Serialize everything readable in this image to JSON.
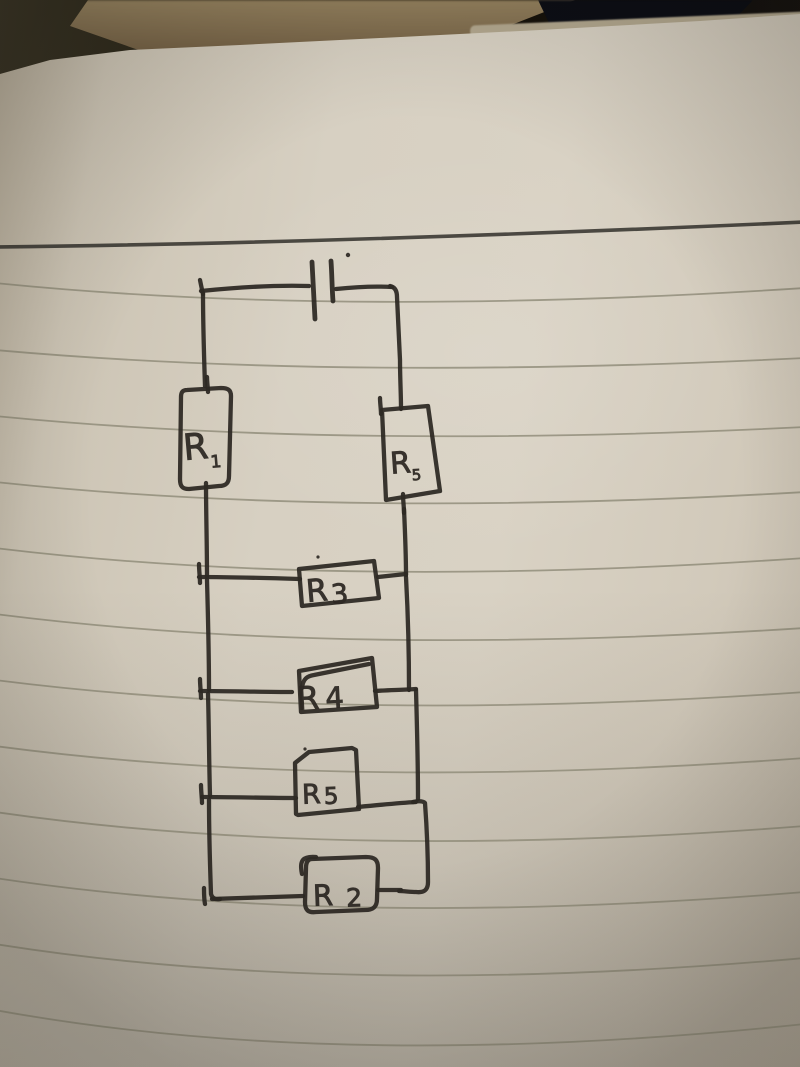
{
  "circuit": {
    "battery": {
      "icon": "battery-symbol"
    },
    "resistors": [
      {
        "id": "r1",
        "letter": "R",
        "sub": "1",
        "position": "left-branch"
      },
      {
        "id": "r5-right",
        "letter": "R",
        "sub": "5",
        "position": "right-branch"
      },
      {
        "id": "r3",
        "letter": "R",
        "sub": "3",
        "position": "parallel-rung-1"
      },
      {
        "id": "r4",
        "letter": "R",
        "sub": "4",
        "position": "parallel-rung-2"
      },
      {
        "id": "r5",
        "letter": "R",
        "sub": "5",
        "position": "parallel-rung-3"
      },
      {
        "id": "r2",
        "letter": "R",
        "sub": "2",
        "position": "parallel-rung-4"
      }
    ]
  },
  "colors": {
    "ink": "#2e2924",
    "paper": "#d7d0c2",
    "ruled_line": "#8d8977",
    "margin_line": "#3b3933",
    "background_dark": "#17120c"
  }
}
